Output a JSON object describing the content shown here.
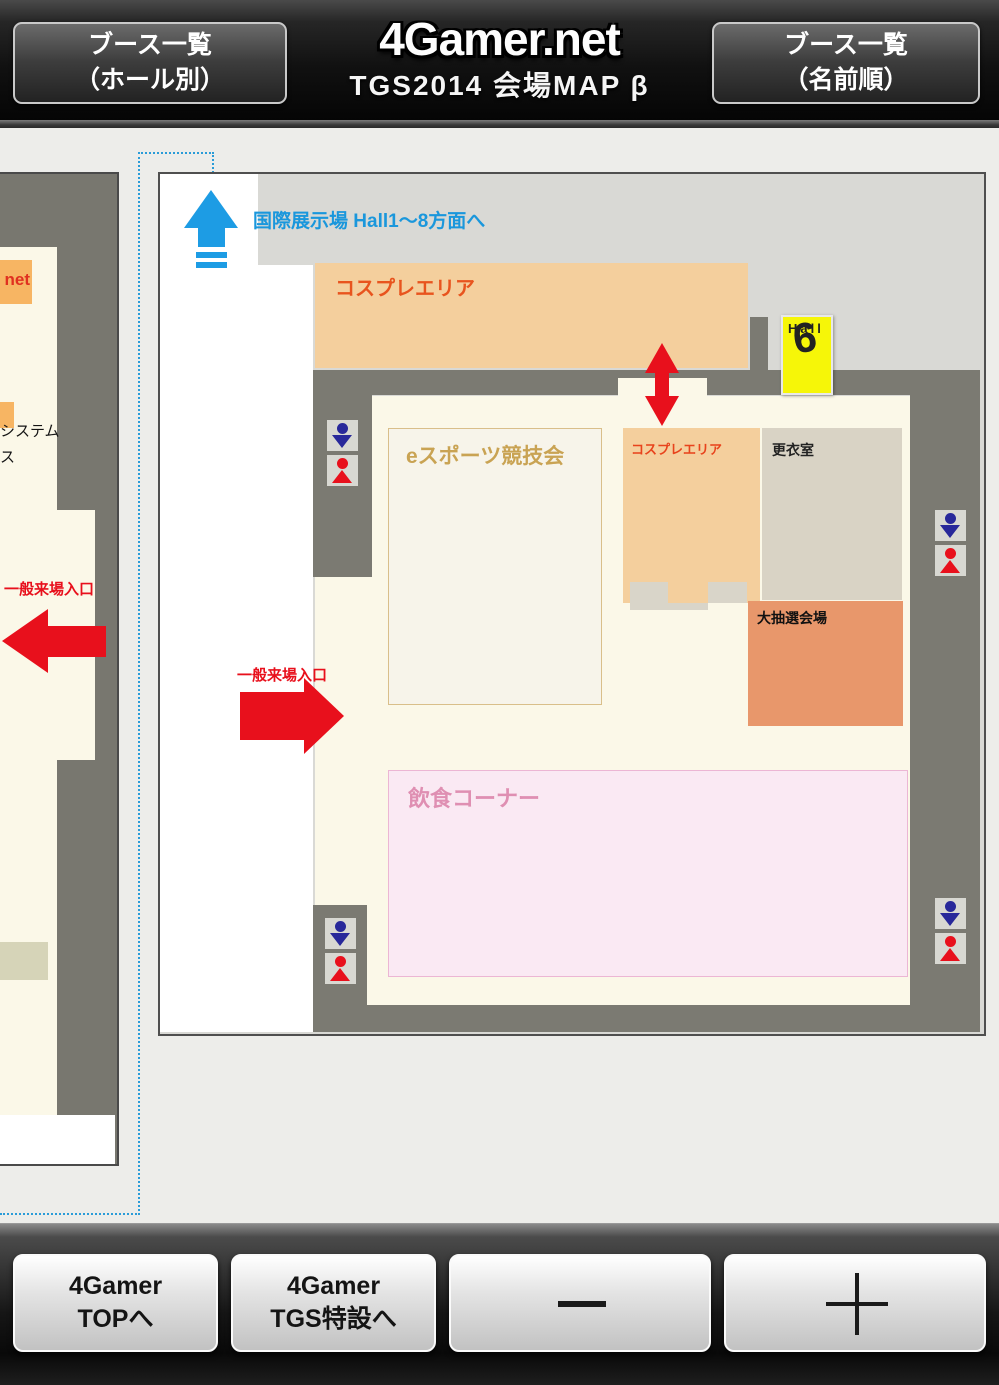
{
  "header": {
    "left_button": {
      "line1": "ブース一覧",
      "line2": "（ホール別）"
    },
    "logo": "4Gamer.net",
    "subtitle": "TGS2014 会場MAP β",
    "right_button": {
      "line1": "ブース一覧",
      "line2": "（名前順）"
    }
  },
  "map": {
    "direction_note": "国際展示場 Hall1～8方面へ",
    "hall9": {
      "hall": "Hall",
      "num": "9"
    },
    "areas": {
      "cosplay_top": "コスプレエリア",
      "esports": "eスポーツ競技会",
      "cosplay_small": "コスプレエリア",
      "changing_room": "更衣室",
      "lottery": "大抽選会場",
      "food": "飲食コーナー"
    },
    "entrance_main": "一般来場入口",
    "left_tile": {
      "entrance": "一般来場入口",
      "booth_net": "net",
      "partial_line1": "システム",
      "partial_line2": "ス"
    }
  },
  "toolbar": {
    "top_button": {
      "line1": "4Gamer",
      "line2": "TOPへ"
    },
    "tgs_button": {
      "line1": "4Gamer",
      "line2": "TGS特設へ"
    },
    "zoom_out": "−",
    "zoom_in": "＋"
  },
  "colors": {
    "accent_blue": "#1d9ce4",
    "entrance_red": "#e8101c",
    "hall9_yellow": "#f6f608",
    "cosplay_tan": "#f4cf9d",
    "changing_gray": "#d9d3c5",
    "lottery_orange": "#e8976b",
    "food_pink": "#fae9f3",
    "wall_gray": "#7b7a72"
  }
}
